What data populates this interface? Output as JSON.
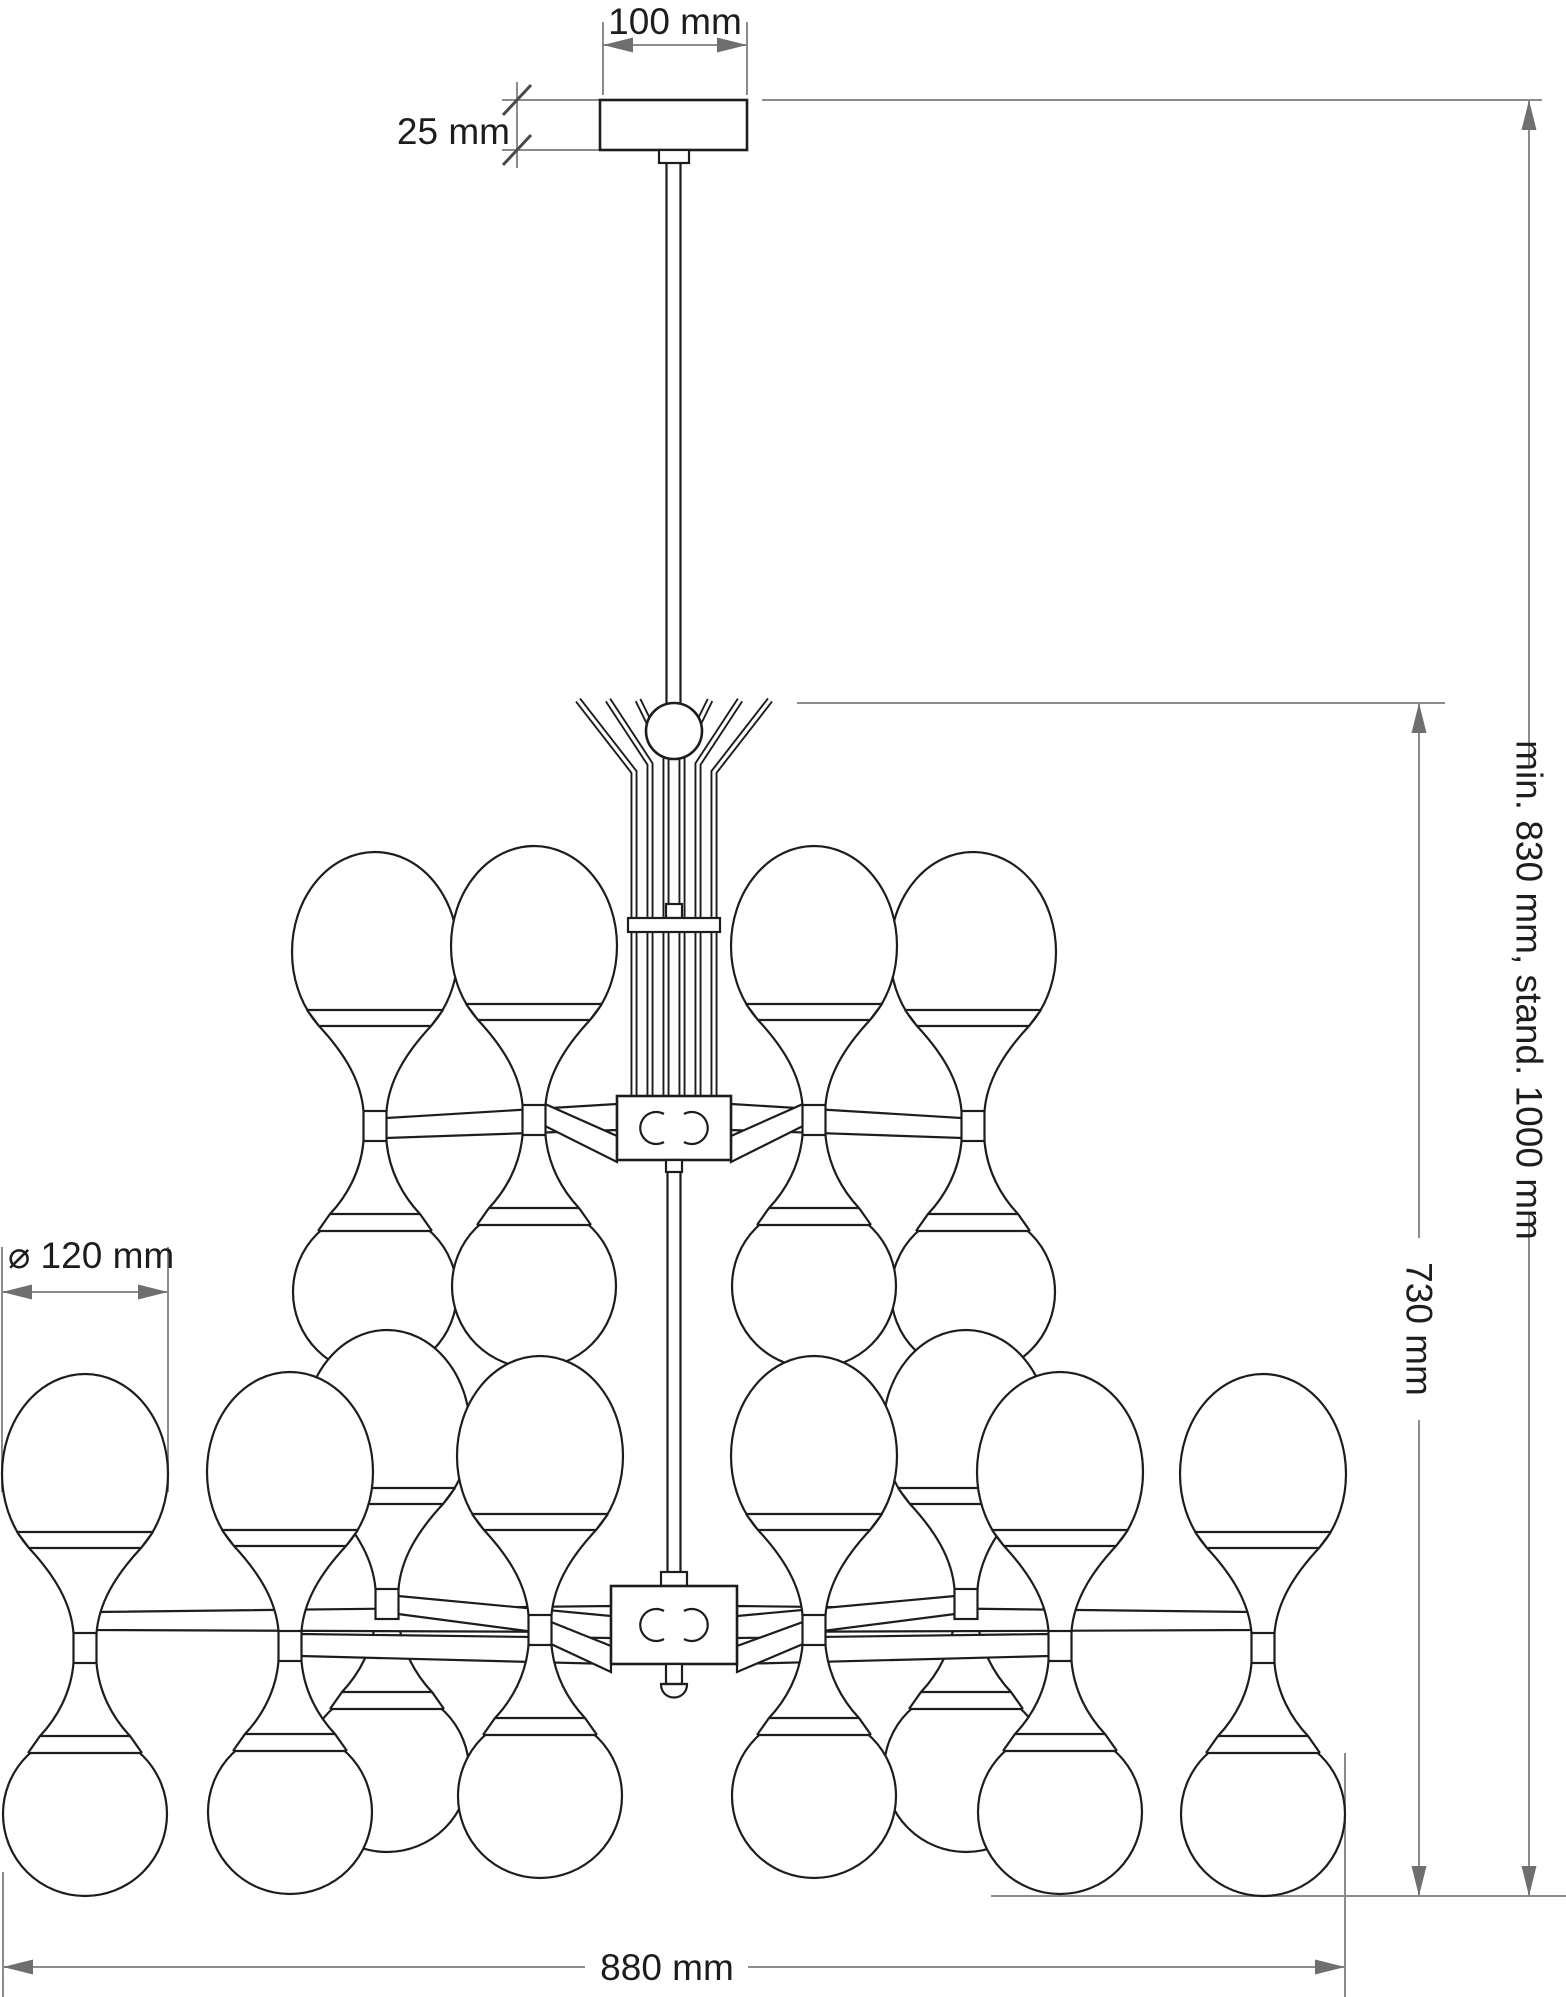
{
  "drawing": {
    "type": "technical dimension drawing",
    "subject": "two-tier chandelier with globe shades",
    "background": "#ffffff",
    "colors": {
      "outline": "#1d1d1b",
      "dimension_line": "#8c8c8c",
      "arrow": "#706f6f",
      "label": "#1d1d1b"
    },
    "labels": {
      "canopy_width": "100 mm",
      "canopy_height": "25 mm",
      "shade_diameter": "⌀ 120 mm",
      "suspension_length": "min. 830 mm, stand. 1000 mm",
      "fixture_height": "730 mm",
      "fixture_width": "880 mm"
    },
    "values": {
      "canopy_width_mm": 100,
      "canopy_height_mm": 25,
      "shade_diameter_mm": 120,
      "suspension_min_mm": 830,
      "suspension_standard_mm": 1000,
      "fixture_height_mm": 730,
      "fixture_width_mm": 880
    }
  }
}
